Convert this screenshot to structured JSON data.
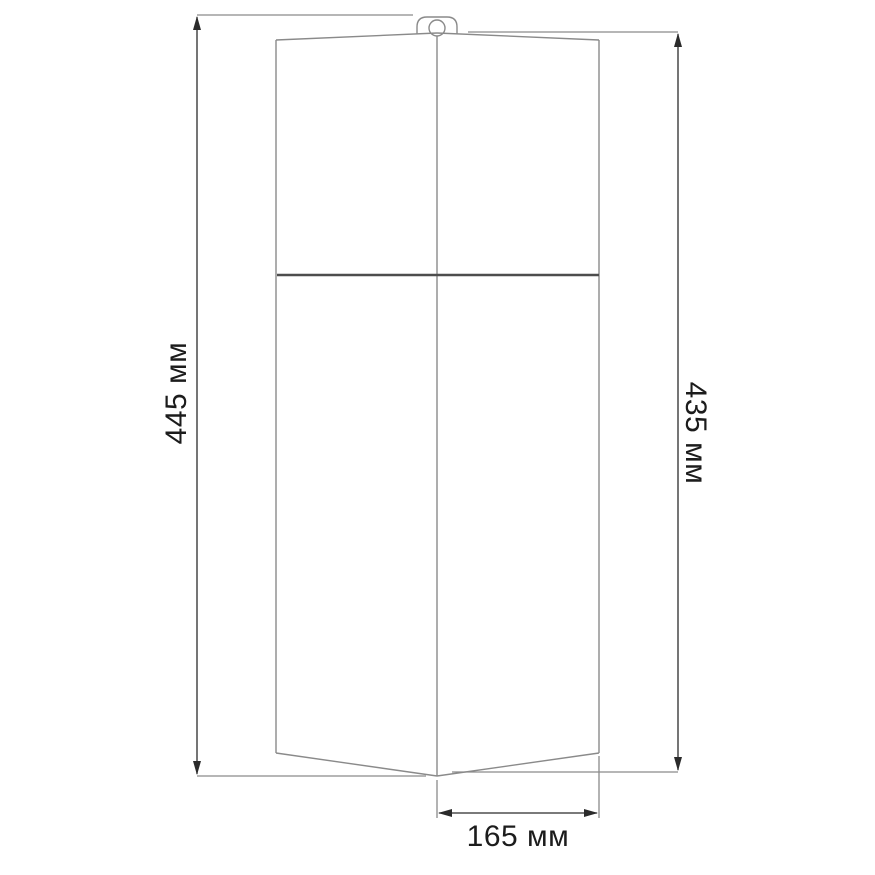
{
  "diagram": {
    "type": "technical-dimension-drawing",
    "unit": "мм",
    "dimensions": {
      "total_height_label": "445 мм",
      "body_height_label": "435 мм",
      "bottom_width_label": "165 мм",
      "total_height_value": 445,
      "body_height_value": 435,
      "bottom_width_value": 165
    },
    "colors": {
      "background": "#ffffff",
      "outline": "#8a8a8a",
      "divider": "#4d4d4d",
      "dimension_line": "#2b2b2b",
      "text": "#1c1c1c"
    }
  }
}
